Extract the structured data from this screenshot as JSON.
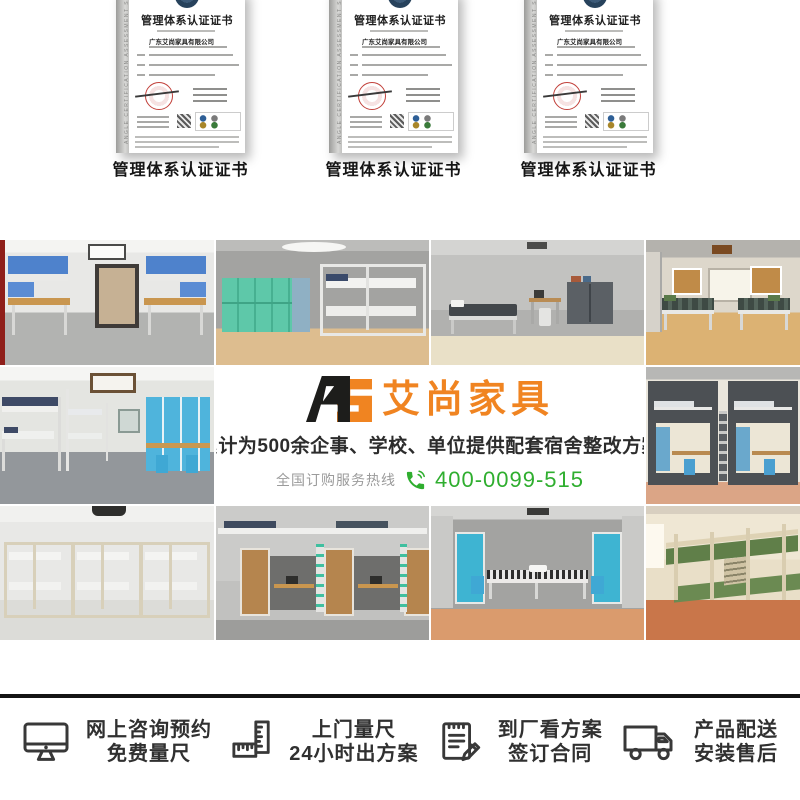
{
  "brand": {
    "monogram_a": "A",
    "monogram_s": "S",
    "name": "艾尚家具",
    "orange": "#f08421",
    "black": "#1d1d1b"
  },
  "certificates": {
    "caption": "管理体系认证证书",
    "cert_title": "管理体系认证证书",
    "company": "广东艾尚家具有限公司",
    "spine_text": "ANGLE CERTIFICATION ASSESSMENT SERVICES",
    "count": 3
  },
  "banner": {
    "tagline": "累计为500余企事、学校、单位提供配套宿舍整改方案",
    "hotline_label": "全国订购服务热线",
    "hotline_number": "400-0099-515",
    "phone_icon": "phone-icon",
    "green": "#2fae2f"
  },
  "services": [
    {
      "icon": "monitor-icon",
      "line1": "网上咨询预约",
      "line2": "免费量尺"
    },
    {
      "icon": "ruler-icon",
      "line1": "上门量尺",
      "line2": "24小时出方案"
    },
    {
      "icon": "contract-icon",
      "line1": "到厂看方案",
      "line2": "签订合同"
    },
    {
      "icon": "truck-icon",
      "line1": "产品配送",
      "line2": "安装售后"
    }
  ]
}
